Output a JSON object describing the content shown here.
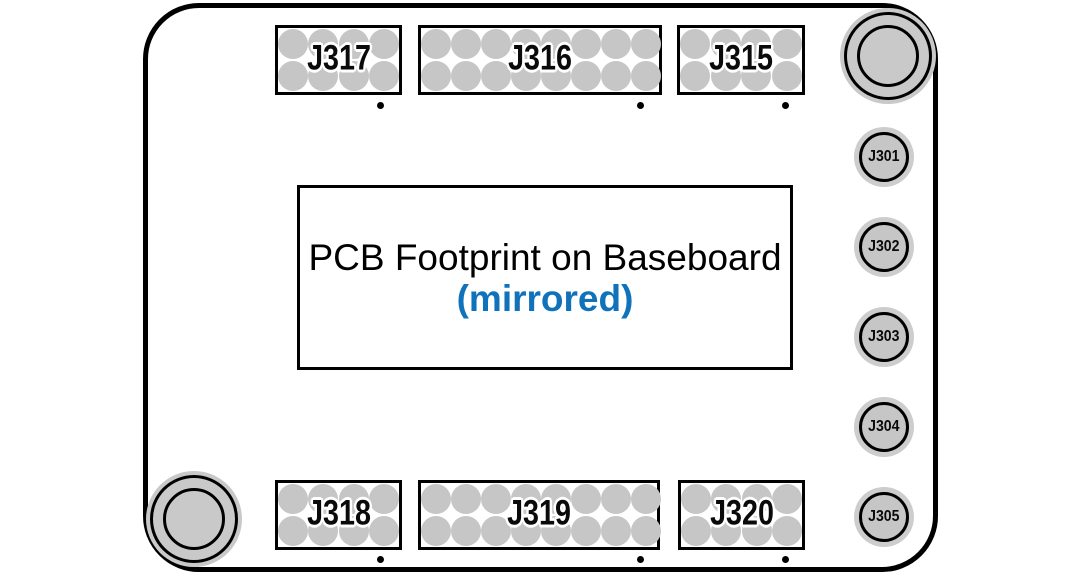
{
  "diagram": {
    "title_line1": "PCB Footprint on Baseboard",
    "title_line2": "(mirrored)"
  },
  "colors": {
    "accent_blue": "#0f72ba",
    "pad_gray": "#c6c6c6",
    "halo_gray": "#cdcdcd",
    "hole_gray": "#c9c9c9",
    "outline_black": "#000000"
  },
  "header_connectors": [
    {
      "label": "J317",
      "cols": 4,
      "rows": 2,
      "x": 275,
      "y": 25,
      "w": 127,
      "h": 70,
      "dot_x": 380,
      "dot_y": 105
    },
    {
      "label": "J316",
      "cols": 8,
      "rows": 2,
      "x": 418,
      "y": 25,
      "w": 244,
      "h": 70,
      "dot_x": 640,
      "dot_y": 105
    },
    {
      "label": "J315",
      "cols": 4,
      "rows": 2,
      "x": 677,
      "y": 25,
      "w": 128,
      "h": 70,
      "dot_x": 785,
      "dot_y": 105
    },
    {
      "label": "J318",
      "cols": 4,
      "rows": 2,
      "x": 275,
      "y": 480,
      "w": 127,
      "h": 70,
      "dot_x": 380,
      "dot_y": 559
    },
    {
      "label": "J319",
      "cols": 8,
      "rows": 2,
      "x": 418,
      "y": 480,
      "w": 242,
      "h": 70,
      "dot_x": 640,
      "dot_y": 559
    },
    {
      "label": "J320",
      "cols": 4,
      "rows": 2,
      "x": 678,
      "y": 480,
      "w": 127,
      "h": 70,
      "dot_x": 785,
      "dot_y": 559
    }
  ],
  "circular_connectors": [
    {
      "label": "J301",
      "cx": 884,
      "cy": 157
    },
    {
      "label": "J302",
      "cx": 884,
      "cy": 247
    },
    {
      "label": "J303",
      "cx": 884,
      "cy": 337
    },
    {
      "label": "J304",
      "cx": 884,
      "cy": 427
    },
    {
      "label": "J305",
      "cx": 884,
      "cy": 517
    }
  ],
  "mounting_holes": [
    {
      "cx": 888,
      "cy": 56
    },
    {
      "cx": 194,
      "cy": 519
    }
  ]
}
